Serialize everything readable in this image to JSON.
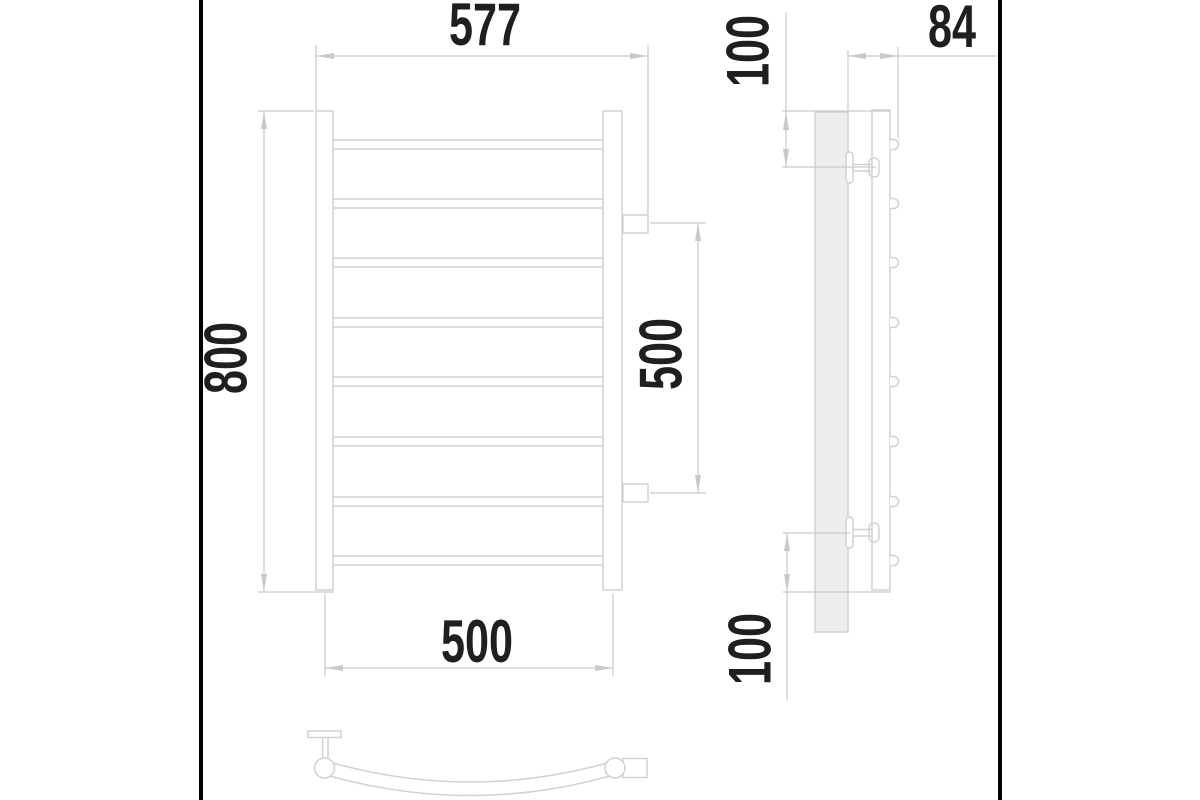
{
  "labels": {
    "overall_width": "577",
    "overall_height": "800",
    "connection_spacing": "500",
    "post_axle_spacing": "500",
    "top_bracket_offset": "100",
    "depth": "84",
    "bottom_bracket_offset": "100"
  },
  "geometry": {
    "front_bar_tops_y": [
      140,
      199,
      258,
      318,
      377,
      437,
      497,
      556
    ],
    "bar_thickness": 9,
    "bar_x1": 333,
    "bar_x2": 603,
    "side_bump_centers_y": [
      144.5,
      203.5,
      262.5,
      322.5,
      381.5,
      441.5,
      501.5,
      560.5
    ],
    "bar_count": 8
  },
  "colors": {
    "drawing_line": "#d2d2d2",
    "dimension_line": "#c9c9c9",
    "label_text": "#1f1f1f",
    "wall_plate_fill": "#ededed",
    "photo_edge": "#000000"
  }
}
